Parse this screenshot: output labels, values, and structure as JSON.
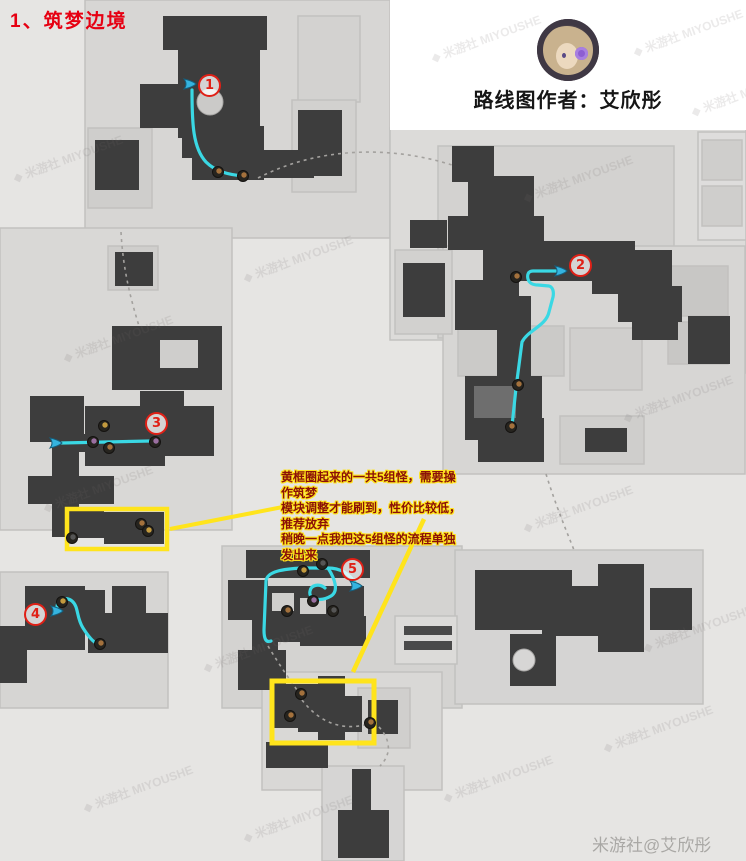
{
  "title": {
    "text": "1、筑梦边境"
  },
  "author": {
    "label": "路线图作者：艾欣彤"
  },
  "annotation": {
    "line1": "黄框圈起来的一共5组怪，需要操作筑梦",
    "line2": "模块调整才能刷到，性价比较低，推荐放弃",
    "line3": "稍晚一点我把这5组怪的流程单独发出来"
  },
  "markers": [
    {
      "label": "1"
    },
    {
      "label": "2"
    },
    {
      "label": "3"
    },
    {
      "label": "4"
    },
    {
      "label": "5"
    }
  ],
  "watermark": {
    "tile": "◆ 米游社 MIYOUSHE",
    "corner": "米游社@艾欣彤"
  },
  "icons": {
    "waypoint": "teleport-waypoint-icon",
    "enemy": "enemy-icon",
    "avatar": "author-avatar-icon"
  },
  "colors": {
    "route": "#3ad8e4",
    "highlight": "#ffe41c",
    "marker": "#e02016",
    "title": "#e60012",
    "annotation_text": "#8a1008",
    "map_dark": "#3d3d3d",
    "map_light": "#d7d6d4"
  }
}
